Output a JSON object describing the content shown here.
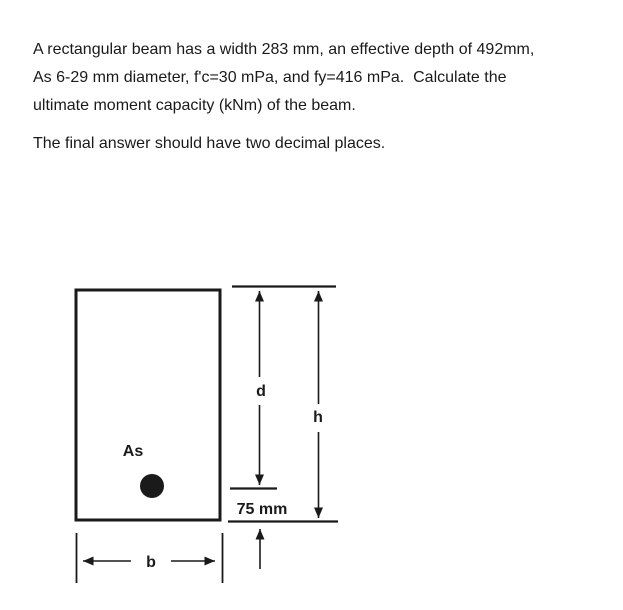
{
  "colors": {
    "ink": "#1a1a1a",
    "background": "#ffffff"
  },
  "problem": {
    "lines": [
      "A rectangular beam has a width 283 mm, an effective depth of 492mm,",
      "As 6-29 mm diameter, f'c=30 mPa, and fy=416 mPa.  Calculate the",
      "ultimate moment capacity (kNm) of the beam."
    ],
    "note": "The final answer should have two decimal places."
  },
  "figure": {
    "steel_area_label": "As",
    "effective_depth_label": "d",
    "overall_height_label": "h",
    "cover_label": "75 mm",
    "width_label": "b"
  }
}
